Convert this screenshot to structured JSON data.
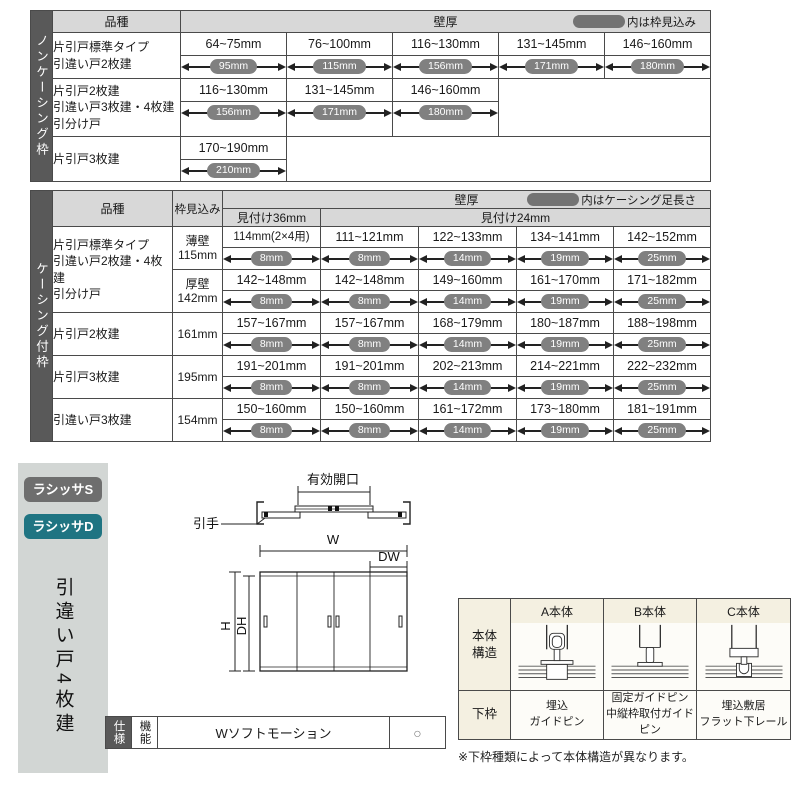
{
  "colors": {
    "accent_teal": "#1f7482",
    "badge_gray": "#6e6e6e",
    "side_bar": "#595959",
    "header_gray": "#d8d8d8",
    "pill_gray": "#808080",
    "panel_gray": "#d2d6d4",
    "table_cream": "#f4f0e1"
  },
  "table1": {
    "side_label": "ノンケーシング枠",
    "col_product": "品種",
    "col_wall": "壁厚",
    "legend": "内は枠見込み",
    "rows": [
      {
        "label": "片引戸標準タイプ\n引違い戸2枚建",
        "cells": [
          {
            "range": "64~75mm",
            "pill": "95mm"
          },
          {
            "range": "76~100mm",
            "pill": "115mm"
          },
          {
            "range": "116~130mm",
            "pill": "156mm"
          },
          {
            "range": "131~145mm",
            "pill": "171mm"
          },
          {
            "range": "146~160mm",
            "pill": "180mm"
          }
        ]
      },
      {
        "label": "片引戸2枚建\n引違い戸3枚建・4枚建\n引分け戸",
        "cells": [
          {
            "range": "116~130mm",
            "pill": "156mm"
          },
          {
            "range": "131~145mm",
            "pill": "171mm"
          },
          {
            "range": "146~160mm",
            "pill": "180mm"
          }
        ]
      },
      {
        "label": "片引戸3枚建",
        "cells": [
          {
            "range": "170~190mm",
            "pill": "210mm"
          }
        ]
      }
    ]
  },
  "table2": {
    "side_label": "ケーシング付枠",
    "col_product": "品種",
    "col_depth": "枠見込み",
    "col_wall": "壁厚",
    "legend": "内はケーシング足長さ",
    "sub36": "見付け36mm",
    "sub24": "見付け24mm",
    "rows": [
      {
        "label": "片引戸標準タイプ\n引違い戸2枚建・4枚建\n引分け戸",
        "depth": "薄壁\n115mm",
        "cells": [
          {
            "range": "114mm(2×4用)",
            "pill": "8mm"
          },
          {
            "range": "111~121mm",
            "pill": "8mm"
          },
          {
            "range": "122~133mm",
            "pill": "14mm"
          },
          {
            "range": "134~141mm",
            "pill": "19mm"
          },
          {
            "range": "142~152mm",
            "pill": "25mm"
          }
        ]
      },
      {
        "label": "",
        "depth": "厚壁\n142mm",
        "cells": [
          {
            "range": "142~148mm",
            "pill": "8mm"
          },
          {
            "range": "142~148mm",
            "pill": "8mm"
          },
          {
            "range": "149~160mm",
            "pill": "14mm"
          },
          {
            "range": "161~170mm",
            "pill": "19mm"
          },
          {
            "range": "171~182mm",
            "pill": "25mm"
          }
        ]
      },
      {
        "label": "片引戸2枚建",
        "depth": "161mm",
        "cells": [
          {
            "range": "157~167mm",
            "pill": "8mm"
          },
          {
            "range": "157~167mm",
            "pill": "8mm"
          },
          {
            "range": "168~179mm",
            "pill": "14mm"
          },
          {
            "range": "180~187mm",
            "pill": "19mm"
          },
          {
            "range": "188~198mm",
            "pill": "25mm"
          }
        ]
      },
      {
        "label": "片引戸3枚建",
        "depth": "195mm",
        "cells": [
          {
            "range": "191~201mm",
            "pill": "8mm"
          },
          {
            "range": "191~201mm",
            "pill": "8mm"
          },
          {
            "range": "202~213mm",
            "pill": "14mm"
          },
          {
            "range": "214~221mm",
            "pill": "19mm"
          },
          {
            "range": "222~232mm",
            "pill": "25mm"
          }
        ]
      },
      {
        "label": "引違い戸3枚建",
        "depth": "154mm",
        "cells": [
          {
            "range": "150~160mm",
            "pill": "8mm"
          },
          {
            "range": "150~160mm",
            "pill": "8mm"
          },
          {
            "range": "161~172mm",
            "pill": "14mm"
          },
          {
            "range": "173~180mm",
            "pill": "19mm"
          },
          {
            "range": "181~191mm",
            "pill": "25mm"
          }
        ]
      }
    ]
  },
  "bottom": {
    "badges": {
      "s": "ラシッサS",
      "d": "ラシッサD"
    },
    "product_title": "引違い戸4枚建",
    "diagram": {
      "effective_opening": "有効開口",
      "handle": "引手",
      "w": "W",
      "dw": "DW",
      "h": "H",
      "dh": "DH"
    },
    "func_table": {
      "spec": "仕様",
      "func": "機能",
      "name": "Wソフトモーション",
      "value": "○"
    },
    "struct_table": {
      "body_label": "本体\n構造",
      "sill_label": "下枠",
      "columns": [
        {
          "header": "A本体",
          "sill": "埋込\nガイドピン"
        },
        {
          "header": "B本体",
          "sill": "固定ガイドピン\n中縦枠取付ガイドピン"
        },
        {
          "header": "C本体",
          "sill": "埋込敷居\nフラット下レール"
        }
      ],
      "note": "※下枠種類によって本体構造が異なります。"
    }
  }
}
